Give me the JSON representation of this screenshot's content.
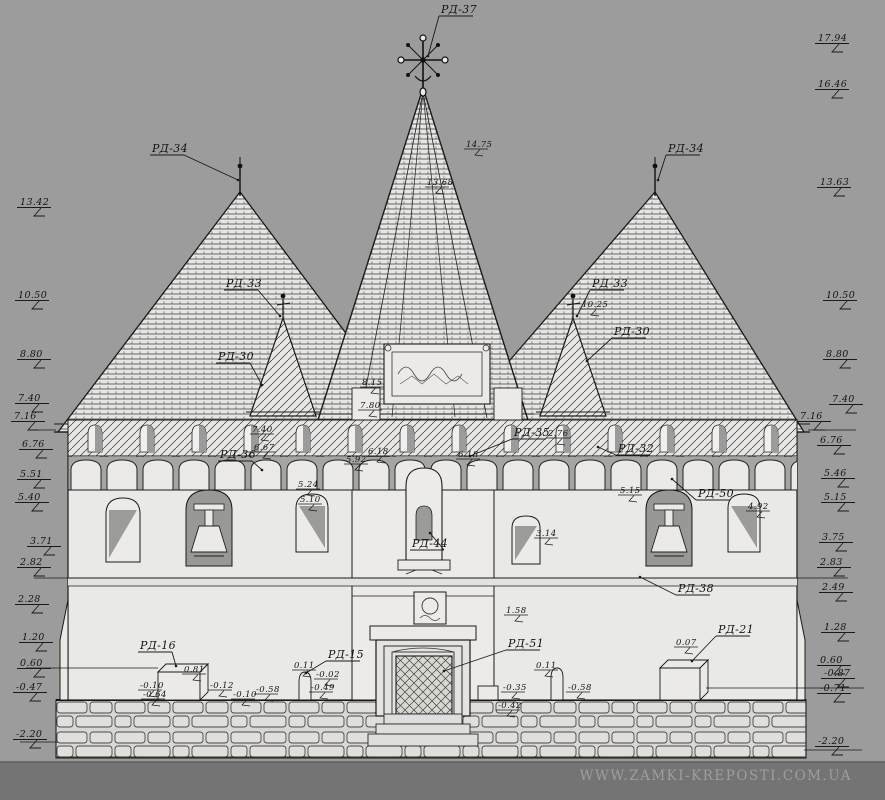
{
  "watermark": "WWW.ZAMKI-KREPOSTI.COM.UA",
  "colors": {
    "background": "#9c9c9c",
    "paper": "#e9e9e6",
    "ink": "#1a1a1a",
    "window_shade": "#989894",
    "footer_band": "#747474",
    "watermark_text": "#9e9e9e"
  },
  "drawing": {
    "type": "architectural-elevation",
    "subject": "fortified-church-facade",
    "callouts": [
      {
        "label": "РД-37",
        "x": 441,
        "y": 13,
        "tx": 428,
        "ty": 56
      },
      {
        "label": "РД-34",
        "x": 152,
        "y": 152,
        "tx": 238,
        "ty": 180
      },
      {
        "label": "РД-34",
        "x": 668,
        "y": 152,
        "tx": 658,
        "ty": 180
      },
      {
        "label": "РД-33",
        "x": 226,
        "y": 287,
        "tx": 280,
        "ty": 316
      },
      {
        "label": "РД-33",
        "x": 592,
        "y": 287,
        "tx": 577,
        "ty": 316
      },
      {
        "label": "РД-30",
        "x": 218,
        "y": 360,
        "tx": 262,
        "ty": 385
      },
      {
        "label": "РД-30",
        "x": 614,
        "y": 335,
        "tx": 587,
        "ty": 361
      },
      {
        "label": "РД-35",
        "x": 514,
        "y": 436,
        "tx": 470,
        "ty": 456
      },
      {
        "label": "РД-36",
        "x": 220,
        "y": 458,
        "tx": 262,
        "ty": 470
      },
      {
        "label": "РД-32",
        "x": 618,
        "y": 452,
        "tx": 598,
        "ty": 447
      },
      {
        "label": "РД-50",
        "x": 698,
        "y": 497,
        "tx": 672,
        "ty": 479
      },
      {
        "label": "РД-38",
        "x": 678,
        "y": 592,
        "tx": 640,
        "ty": 577
      },
      {
        "label": "РД-44",
        "x": 412,
        "y": 547,
        "tx": 430,
        "ty": 533
      },
      {
        "label": "РД-16",
        "x": 140,
        "y": 649,
        "tx": 176,
        "ty": 666
      },
      {
        "label": "РД-15",
        "x": 328,
        "y": 658,
        "tx": 306,
        "ty": 673
      },
      {
        "label": "РД-51",
        "x": 508,
        "y": 647,
        "tx": 444,
        "ty": 671
      },
      {
        "label": "РД-21",
        "x": 718,
        "y": 633,
        "tx": 692,
        "ty": 661
      }
    ],
    "elevation_marks_left": [
      {
        "v": "13.42",
        "x": 20,
        "y": 205
      },
      {
        "v": "10.50",
        "x": 18,
        "y": 298
      },
      {
        "v": "8.80",
        "x": 20,
        "y": 357
      },
      {
        "v": "7.40",
        "x": 18,
        "y": 401
      },
      {
        "v": "7.16",
        "x": 14,
        "y": 419
      },
      {
        "v": "6.76",
        "x": 22,
        "y": 447
      },
      {
        "v": "5.51",
        "x": 20,
        "y": 477
      },
      {
        "v": "5.40",
        "x": 18,
        "y": 500
      },
      {
        "v": "3.71",
        "x": 30,
        "y": 544
      },
      {
        "v": "2.82",
        "x": 20,
        "y": 565
      },
      {
        "v": "2.28",
        "x": 18,
        "y": 602
      },
      {
        "v": "1.20",
        "x": 22,
        "y": 640
      },
      {
        "v": "0.60",
        "x": 20,
        "y": 666
      },
      {
        "v": "-0.47",
        "x": 16,
        "y": 690
      },
      {
        "v": "-2.20",
        "x": 16,
        "y": 737
      }
    ],
    "elevation_marks_right": [
      {
        "v": "17.94",
        "x": 818,
        "y": 41
      },
      {
        "v": "16.46",
        "x": 818,
        "y": 87
      },
      {
        "v": "13.63",
        "x": 820,
        "y": 185
      },
      {
        "v": "10.50",
        "x": 826,
        "y": 298
      },
      {
        "v": "8.80",
        "x": 826,
        "y": 357
      },
      {
        "v": "7.40",
        "x": 832,
        "y": 402
      },
      {
        "v": "7.16",
        "x": 800,
        "y": 419
      },
      {
        "v": "6.76",
        "x": 820,
        "y": 443
      },
      {
        "v": "5.46",
        "x": 824,
        "y": 476
      },
      {
        "v": "5.15",
        "x": 824,
        "y": 500
      },
      {
        "v": "3.75",
        "x": 822,
        "y": 540
      },
      {
        "v": "2.83",
        "x": 820,
        "y": 565
      },
      {
        "v": "2.49",
        "x": 822,
        "y": 590
      },
      {
        "v": "1.28",
        "x": 824,
        "y": 630
      },
      {
        "v": "0.60",
        "x": 820,
        "y": 663
      },
      {
        "v": "-0.87",
        "x": 824,
        "y": 676
      },
      {
        "v": "-0.71",
        "x": 820,
        "y": 691
      },
      {
        "v": "-2.20",
        "x": 818,
        "y": 744
      }
    ],
    "dimensions": [
      {
        "v": "14.75",
        "x": 466,
        "y": 147
      },
      {
        "v": "13.68",
        "x": 427,
        "y": 185
      },
      {
        "v": "10.25",
        "x": 582,
        "y": 307
      },
      {
        "v": "8.15",
        "x": 362,
        "y": 385
      },
      {
        "v": "7.80",
        "x": 360,
        "y": 408
      },
      {
        "v": "7.40",
        "x": 252,
        "y": 432
      },
      {
        "v": "6.67",
        "x": 254,
        "y": 450
      },
      {
        "v": "6.18",
        "x": 368,
        "y": 454
      },
      {
        "v": "5.92",
        "x": 346,
        "y": 462
      },
      {
        "v": "6.18",
        "x": 458,
        "y": 457
      },
      {
        "v": "2.76",
        "x": 548,
        "y": 436
      },
      {
        "v": "5.24",
        "x": 298,
        "y": 487
      },
      {
        "v": "5.10",
        "x": 300,
        "y": 502
      },
      {
        "v": "5.15",
        "x": 620,
        "y": 493
      },
      {
        "v": "4.92",
        "x": 748,
        "y": 509
      },
      {
        "v": "3.14",
        "x": 536,
        "y": 536
      },
      {
        "v": "1.58",
        "x": 506,
        "y": 613
      },
      {
        "v": "0.81",
        "x": 184,
        "y": 672
      },
      {
        "v": "-0.10",
        "x": 140,
        "y": 688
      },
      {
        "v": "-0.64",
        "x": 143,
        "y": 697
      },
      {
        "v": "-0.12",
        "x": 210,
        "y": 688
      },
      {
        "v": "-0.10",
        "x": 233,
        "y": 697
      },
      {
        "v": "-0.58",
        "x": 256,
        "y": 692
      },
      {
        "v": "0.11",
        "x": 294,
        "y": 668
      },
      {
        "v": "-0.02",
        "x": 316,
        "y": 677
      },
      {
        "v": "-0.49",
        "x": 311,
        "y": 690
      },
      {
        "v": "0.11",
        "x": 536,
        "y": 668
      },
      {
        "v": "-0.35",
        "x": 503,
        "y": 690
      },
      {
        "v": "-0.58",
        "x": 568,
        "y": 690
      },
      {
        "v": "-0.42",
        "x": 498,
        "y": 708
      },
      {
        "v": "0.07",
        "x": 676,
        "y": 645
      }
    ]
  }
}
